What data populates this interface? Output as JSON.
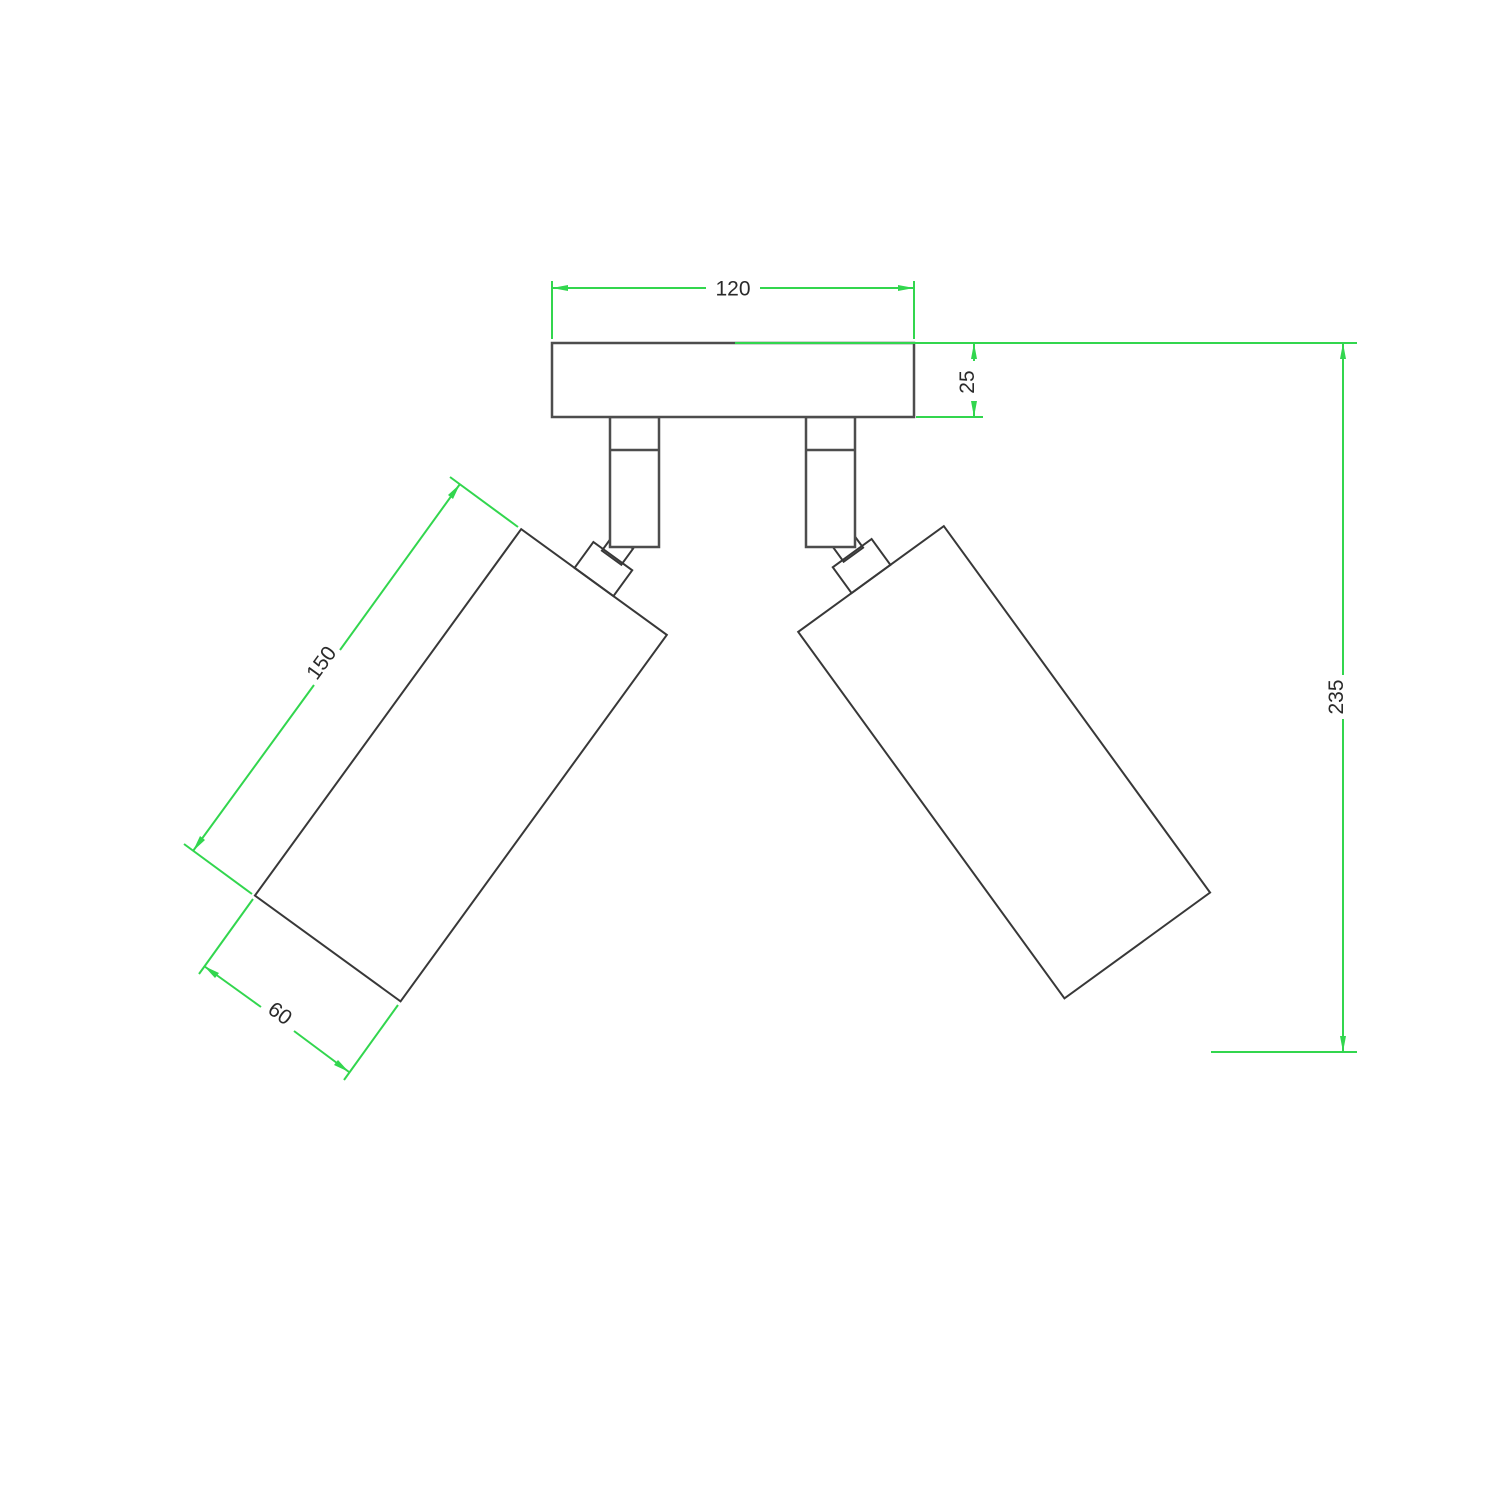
{
  "drawing": {
    "title": "ceiling-spotlight-dimension-drawing",
    "view": "front elevation, twin adjustable spot lamp on rectangular canopy",
    "dimensions": {
      "canopy_width": "120",
      "canopy_thickness": "25",
      "overall_drop": "235",
      "spot_body_length": "150",
      "spot_body_diameter": "60"
    }
  },
  "colors": {
    "dimension_lines": "#32d64e",
    "fixture_outline": "#4d4d4d",
    "fixture_outline_dark": "#383838",
    "text": "#2a2a2a",
    "background": "#ffffff"
  }
}
